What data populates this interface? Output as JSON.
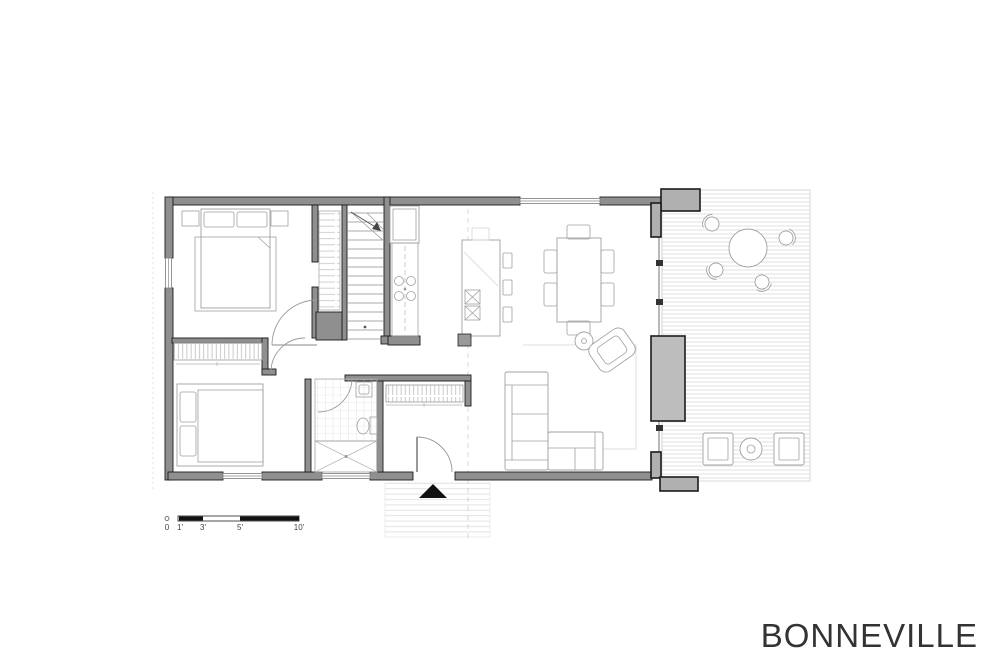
{
  "title": {
    "text": "BONNEVILLE"
  },
  "scale_bar": {
    "labels": [
      "0",
      "1'",
      "3'",
      "5'",
      "10'"
    ],
    "bar_color": "#111111"
  },
  "icons": {
    "entry-arrow-icon": "▲",
    "stair-direction-arrow-icon": "↗"
  },
  "colors": {
    "background": "#ffffff",
    "walls": "#8f8f8f",
    "wall_outline": "#1c1c1c",
    "furniture": "#a0a0a0",
    "deck_boards": "#d9d9d9",
    "planter_fill": "#bdbdbd",
    "pillar_fill": "#b0b0b0",
    "title_color": "#333333",
    "scale_ink": "#111111"
  }
}
